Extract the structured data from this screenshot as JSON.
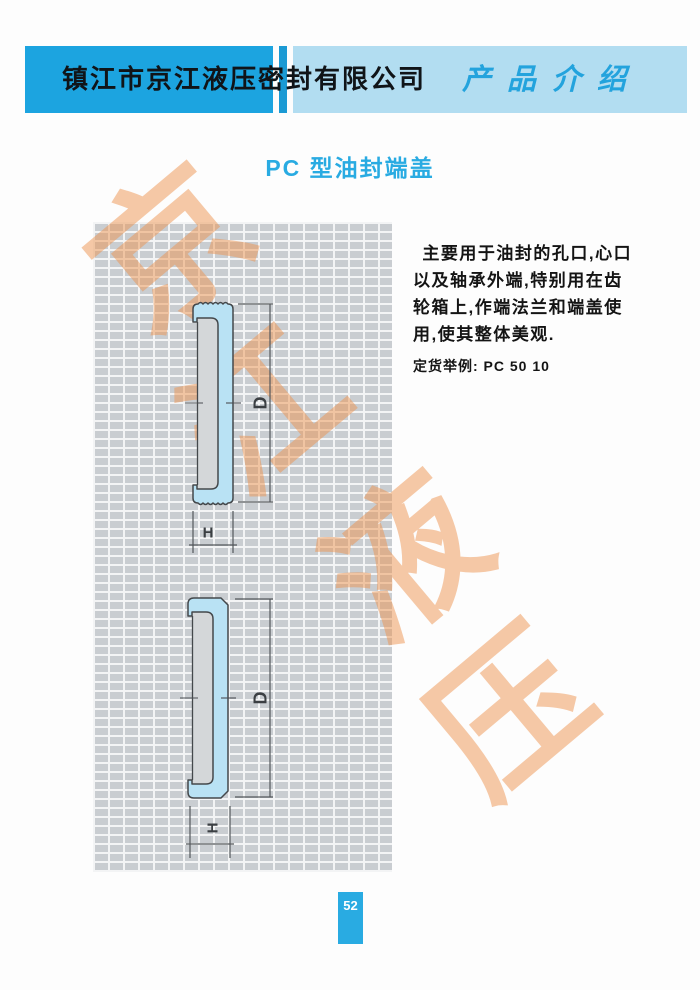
{
  "header": {
    "company": "镇江市京江液压密封有限公司",
    "section": "产品介绍"
  },
  "title": "PC 型油封端盖",
  "description": {
    "lines": [
      "主要用于油封的孔口,心口",
      "以及轴承外端,特别用在齿",
      "轮箱上,作端法兰和端盖使",
      "用,使其整体美观."
    ]
  },
  "order_example": "定货举例: PC 50 10",
  "watermark": {
    "chars": [
      "京",
      "江",
      "液",
      "压"
    ]
  },
  "diagrams": [
    {
      "name": "serrated-end-cap-section",
      "d_label": "D",
      "h_label": "H"
    },
    {
      "name": "smooth-end-cap-section",
      "d_label": "D",
      "h_label": "H"
    }
  ],
  "page_number": "52",
  "colors": {
    "accent_blue": "#29abe2",
    "header_light_blue": "#b2ddf1",
    "seal_fill": "#b9e2f4",
    "grid_background": "#c9cdd1",
    "watermark_orange": "#ee9450"
  }
}
